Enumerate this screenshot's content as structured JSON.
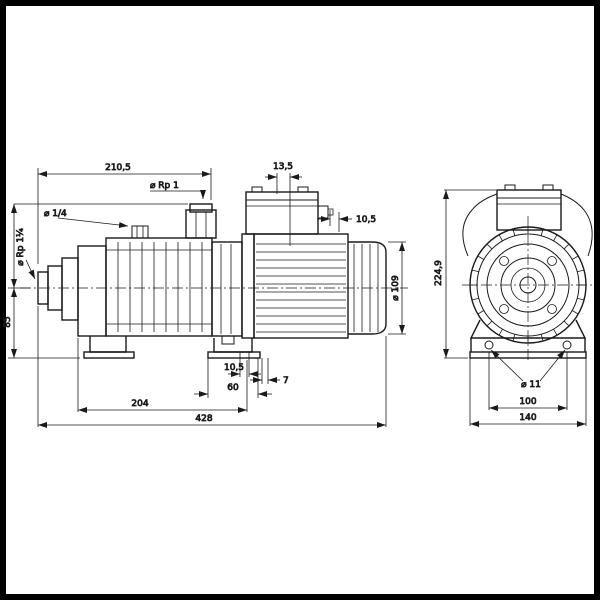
{
  "drawing": {
    "subject": "dimensional drawing of a horizontal multistage centrifugal pump, side view and front view",
    "line_color": "#1a1a1a",
    "background_color": "#ffffff",
    "border_color": "#000000",
    "side_view": {
      "dim_top_length": "210,5",
      "discharge_port": "⌀ Rp 1",
      "vent_plug": "⌀ 1/4",
      "dim_cable_entry": "13,5",
      "dim_rear_gap": "10,5",
      "suction_port": "⌀ Rp 1¼",
      "dim_centerline_height": "85",
      "dim_motor_diameter": "⌀ 109",
      "dim_foot_hole_offset": "10,5",
      "dim_rear_foot_length": "60",
      "dim_foot_step": "7",
      "dim_body_length": "204",
      "dim_total_length": "428"
    },
    "front_view": {
      "dim_total_height": "224,9",
      "foot_hole_diameter": "⌀ 11",
      "dim_foot_hole_spacing": "100",
      "dim_foot_width": "140"
    }
  }
}
